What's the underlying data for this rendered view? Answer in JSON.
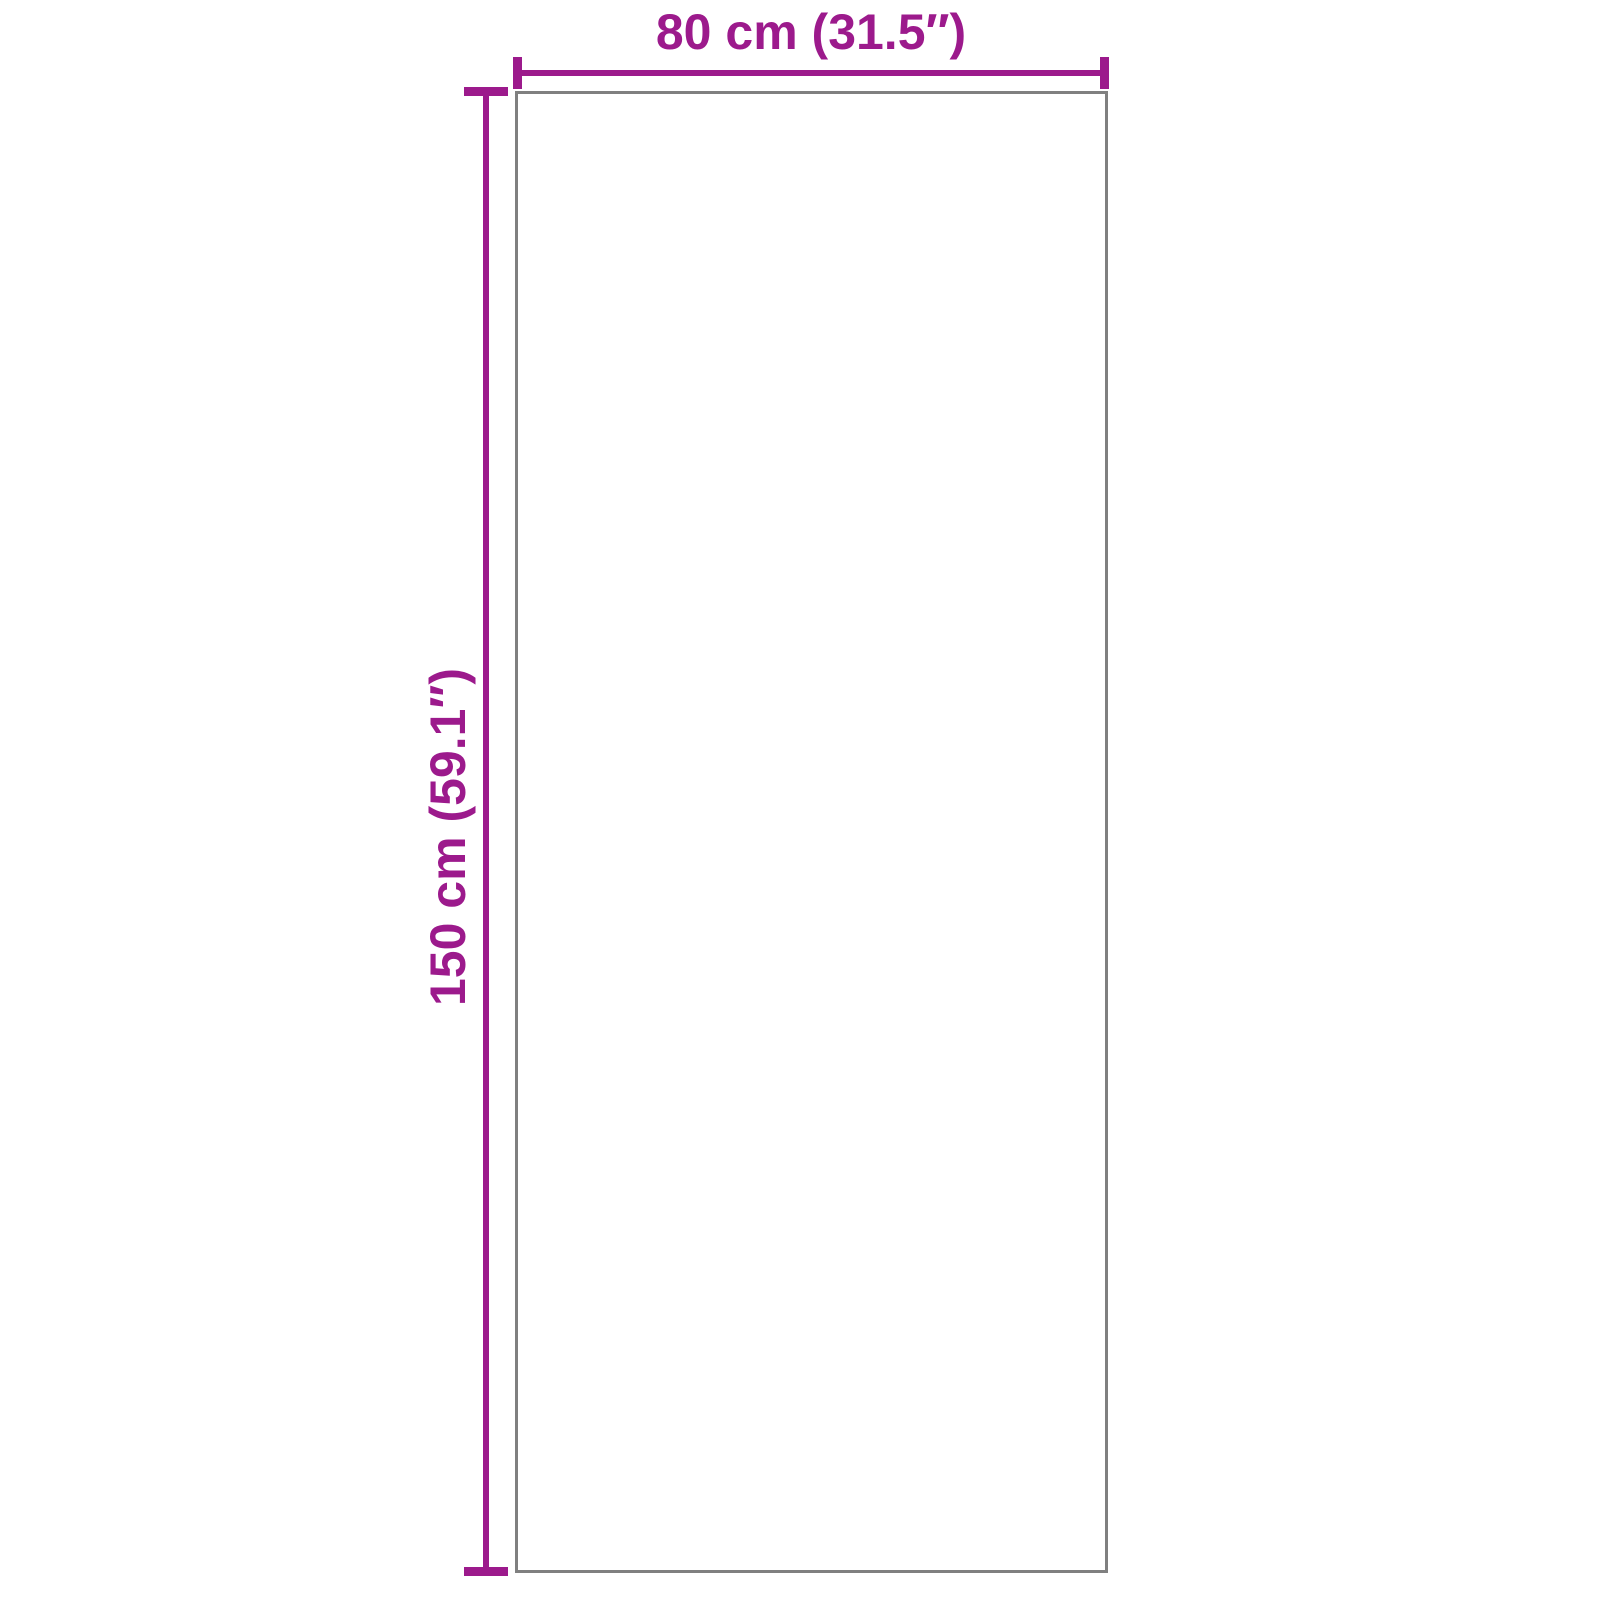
{
  "diagram": {
    "width_label": "80 cm (31.5″)",
    "height_label": "150 cm (59.1″)",
    "colors": {
      "dimension": "#9C1A8C",
      "outline": "#808080",
      "background": "#FFFFFF"
    }
  }
}
